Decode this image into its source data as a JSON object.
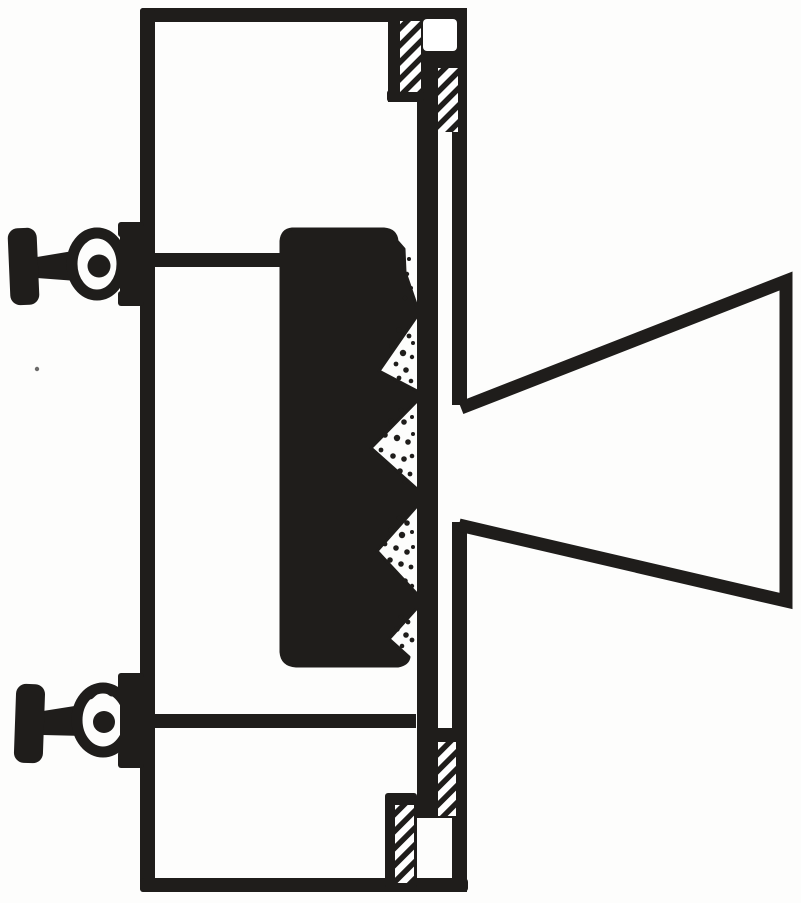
{
  "colors": {
    "ink": "#1f1d1b",
    "paper": "#fdfdfc"
  },
  "drawing": {
    "kind": "patent-style-sectional-line-drawing",
    "parts": [
      "outer-frame-box",
      "upper-thumbscrew-clamp",
      "lower-thumbscrew-clamp",
      "connecting-rod-upper",
      "connecting-rod-lower",
      "serrated-carbon-block",
      "slotted-front-plate",
      "threaded-fastening-screws",
      "flaring-horn"
    ]
  }
}
